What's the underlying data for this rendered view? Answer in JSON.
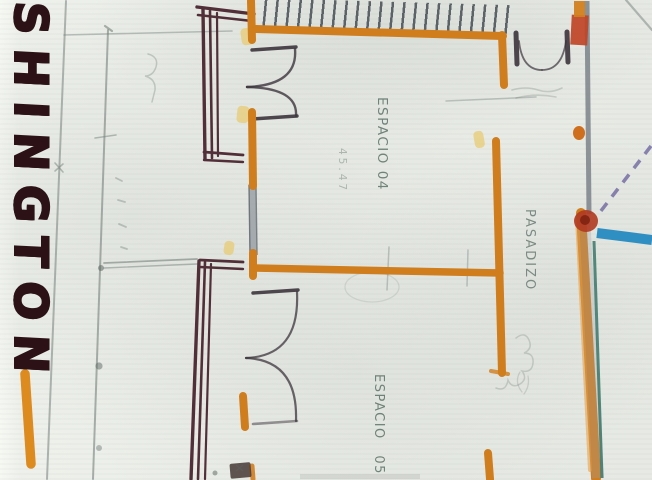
{
  "plan": {
    "street_label": "SHINGTON",
    "rooms": [
      {
        "label": "ESPACIO 04",
        "area_note": "45.47"
      },
      {
        "label": "PASADIZO"
      },
      {
        "label": "ESPACIO 05"
      }
    ]
  },
  "palette": {
    "paper": "#eef1eb",
    "orange_marker": "#d07d1d",
    "maroon_wall": "#4b2530",
    "dark_ink": "#3c343c",
    "pencil": "#76807c",
    "label_green": "#5c7268",
    "street_text": "#2c1216",
    "blue_line": "#2f8fc2",
    "teal_line": "#2e6f62",
    "purple_dashed": "#6f67a0",
    "red_block": "#bf4426",
    "highlighter": "#e8cc74"
  }
}
